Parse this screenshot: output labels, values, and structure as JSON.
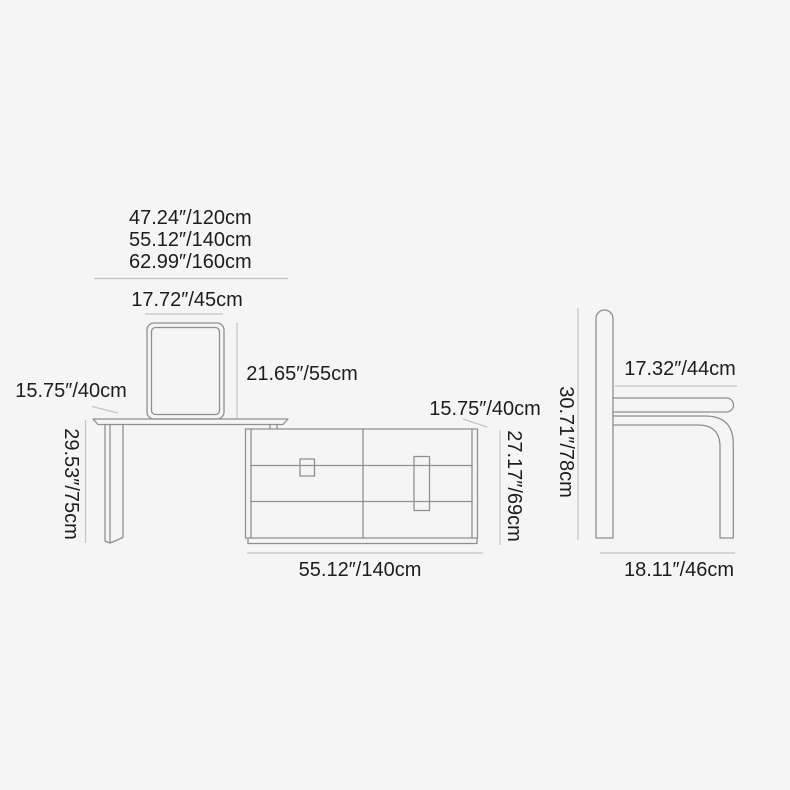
{
  "colors": {
    "bg": "#f5f5f5",
    "line": "#8f8f8f",
    "dimline": "#c4c4c4",
    "text": "#1d1d1d"
  },
  "diagram": {
    "desk": {
      "width_options": [
        "47.24″/120cm",
        "55.12″/140cm",
        "62.99″/160cm"
      ],
      "mirror_width": "17.72″/45cm",
      "mirror_height": "21.65″/55cm",
      "depth": "15.75″/40cm",
      "height": "29.53″/75cm"
    },
    "cabinet": {
      "depth": "15.75″/40cm",
      "height": "27.17″/69cm",
      "width": "55.12″/140cm"
    },
    "chair": {
      "seat_width": "17.32″/44cm",
      "height": "30.71″/78cm",
      "base_width": "18.11″/46cm"
    }
  }
}
